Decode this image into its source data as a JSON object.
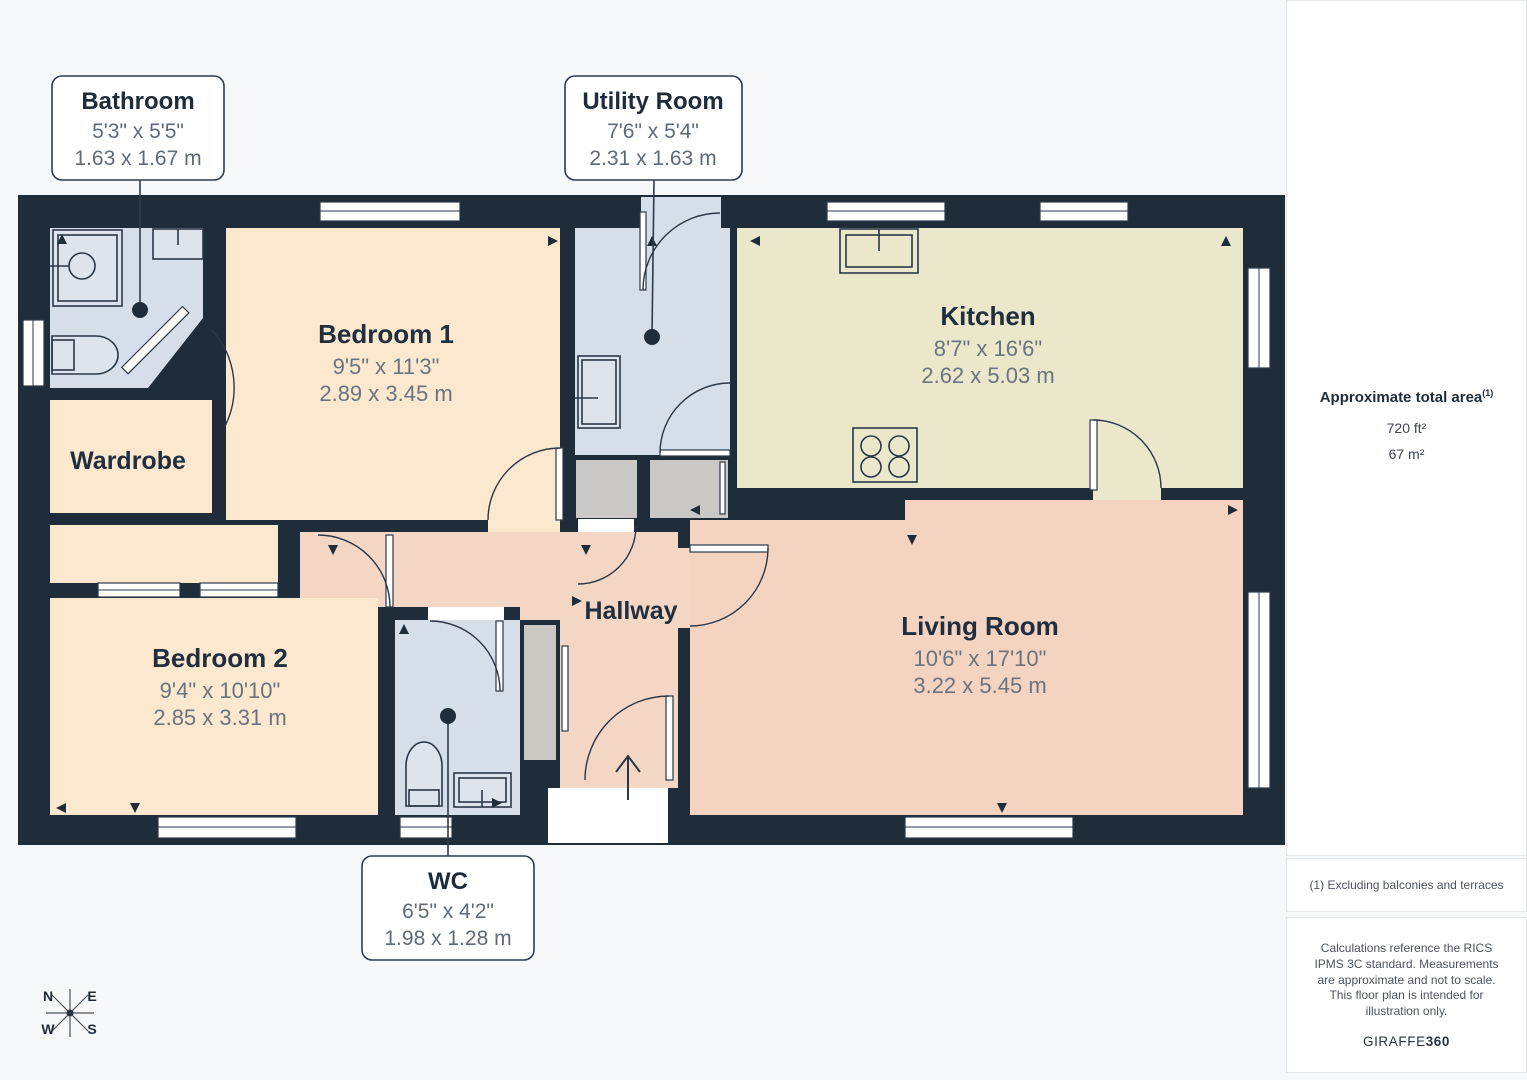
{
  "rooms": {
    "bedroom1": {
      "name": "Bedroom 1",
      "imperial": "9'5\" x 11'3\"",
      "metric": "2.89 x 3.45 m"
    },
    "bedroom2": {
      "name": "Bedroom 2",
      "imperial": "9'4\" x 10'10\"",
      "metric": "2.85 x 3.31 m"
    },
    "kitchen": {
      "name": "Kitchen",
      "imperial": "8'7\" x 16'6\"",
      "metric": "2.62 x 5.03 m"
    },
    "living_room": {
      "name": "Living Room",
      "imperial": "10'6\" x 17'10\"",
      "metric": "3.22 x 5.45 m"
    },
    "wardrobe": {
      "name": "Wardrobe"
    },
    "hallway": {
      "name": "Hallway"
    }
  },
  "callouts": {
    "bathroom": {
      "name": "Bathroom",
      "imperial": "5'3\" x 5'5\"",
      "metric": "1.63 x 1.67 m"
    },
    "utility": {
      "name": "Utility Room",
      "imperial": "7'6\" x 5'4\"",
      "metric": "2.31 x 1.63 m"
    },
    "wc": {
      "name": "WC",
      "imperial": "6'5\" x 4'2\"",
      "metric": "1.98 x 1.28 m"
    }
  },
  "sidebar": {
    "area_title": "Approximate total area",
    "area_title_sup": "(1)",
    "area_ft": "720 ft²",
    "area_m": "67 m²",
    "footnote": "(1) Excluding balconies and terraces",
    "disclaimer": "Calculations reference the RICS IPMS 3C standard. Measurements are approximate and not to scale. This floor plan is intended for illustration only.",
    "brand_regular": "GIRAFFE",
    "brand_bold": "360"
  },
  "compass": {
    "n": "N",
    "e": "E",
    "w": "W",
    "s": "S"
  },
  "colors": {
    "wall": "#1f2c3a",
    "bedroom_cream": "#fce8ce",
    "kitchen_khaki": "#ebe7cb",
    "living_pink": "#f4d3c0",
    "wet_room_blue": "#d6dee9",
    "closet_gray": "#c9c8c5",
    "label_dark": "#202e3e",
    "dims_gray": "#6a7480",
    "page_bg": "#f7f8fa"
  }
}
